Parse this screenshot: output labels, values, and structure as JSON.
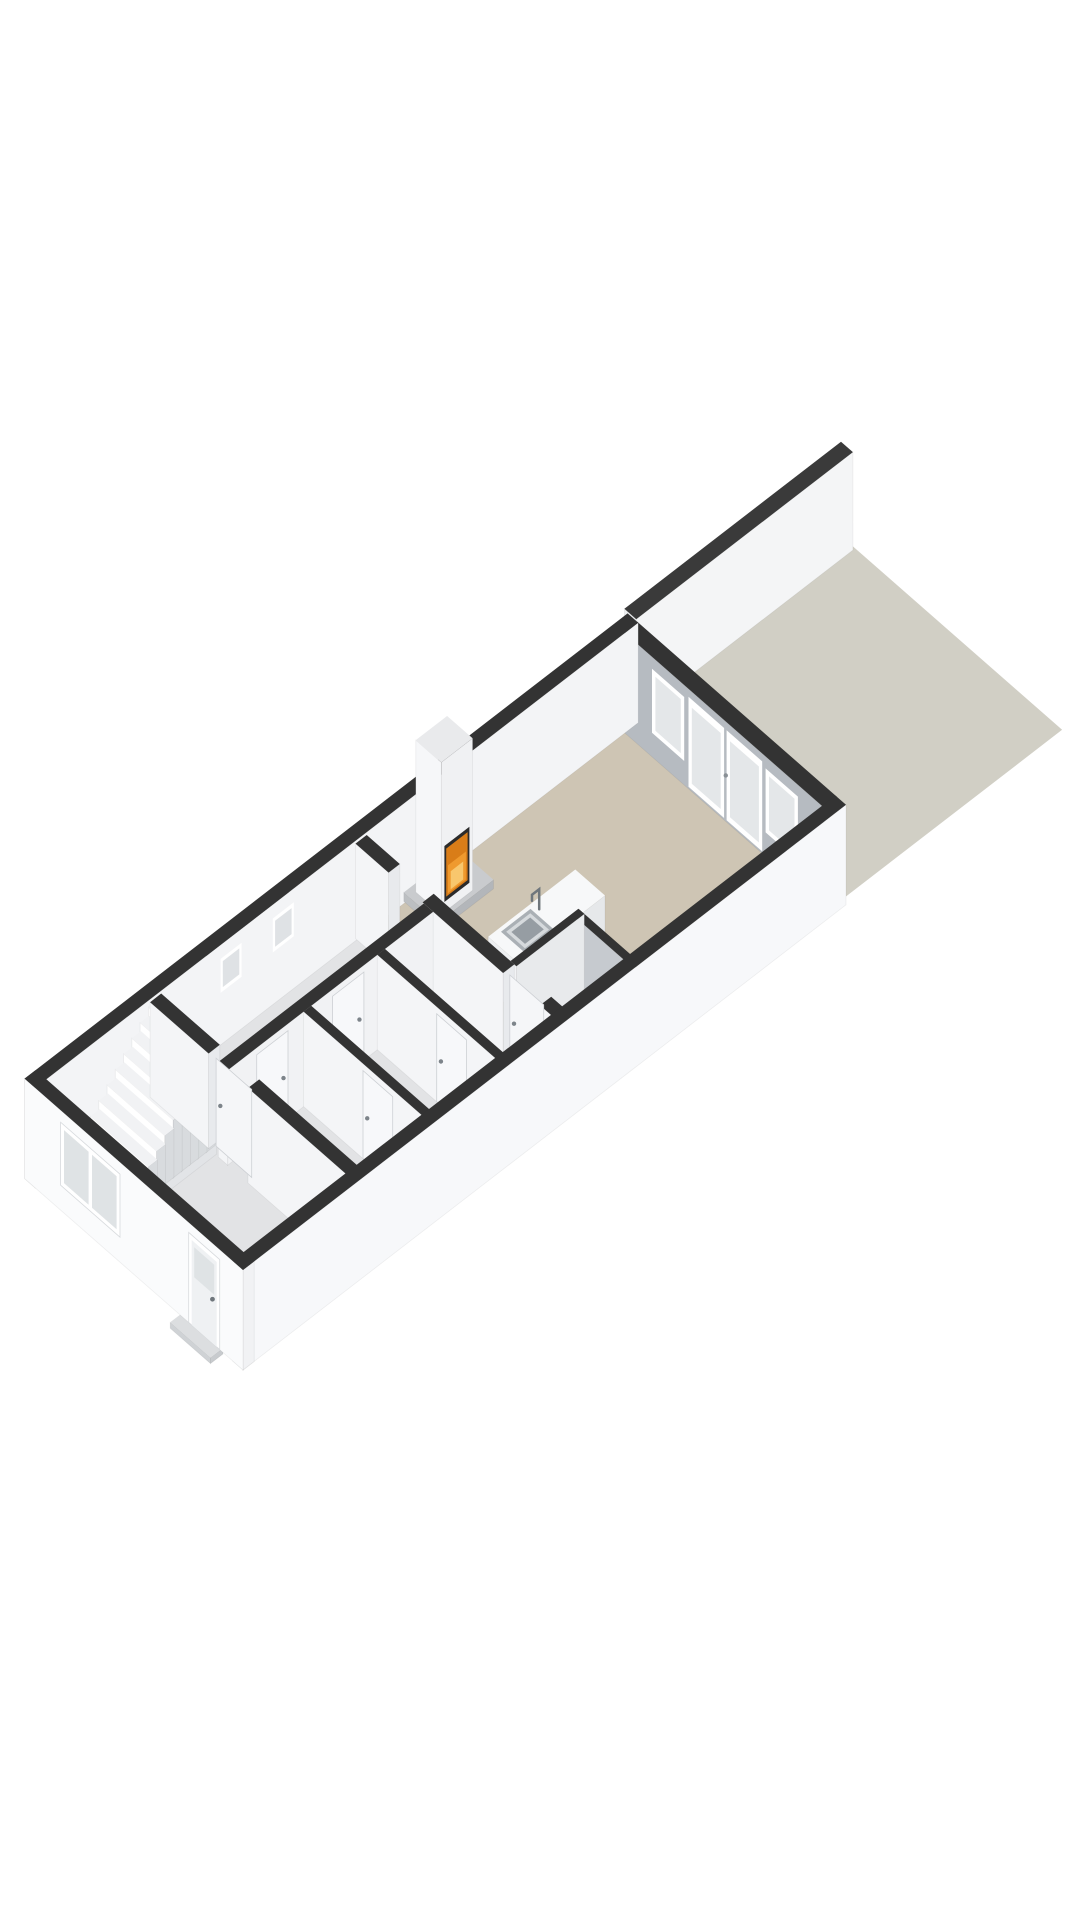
{
  "meta": {
    "type": "3d-floorplan-render",
    "floor": "ground-floor",
    "background": "#ffffff"
  },
  "palette": {
    "wall_top": "#333333",
    "face_bright": "#fafbfc",
    "face_light": "#f2f3f5",
    "face_shade": "#eceef1",
    "face_gray": "#b6bbc1",
    "face_gray_deep": "#c6cacf",
    "floor_gray": "#e2e3e5",
    "floor_tan": "#cec5b4",
    "floor_nook": "#dfe1e3",
    "garden": "#d1cfc5",
    "glass": "#e4e7e9",
    "frame": "#ffffff",
    "fire_dark": "#2b2b2b",
    "fire_base": "#d97d18",
    "fire_mid": "#ef9a2e",
    "fire_hi": "#f8c76d",
    "metal": "#6f767c",
    "edge": "rgba(0,0,0,0.06)"
  },
  "projection": {
    "origin": [
      243,
      1370
    ],
    "ux": 44.67,
    "uy": 34.46,
    "wx": 42.41,
    "wy": 37.17
  },
  "scene": {
    "items": [
      {
        "n": "garden-parcel",
        "t": "floor",
        "z": 0,
        "f": "#d1cfc5",
        "pts": [
          [
            13.5,
            0.12
          ],
          [
            18.45,
            0.12
          ],
          [
            18.45,
            5.1
          ],
          [
            13.5,
            5.1
          ]
        ]
      },
      {
        "n": "garden-boundary-wall",
        "t": "prism",
        "u1": 13.55,
        "u2": 18.4,
        "w1": 5.0,
        "w2": 5.28,
        "z0": 0,
        "z1": 98,
        "ft": "#3a3a3a",
        "fu": "#eceef0",
        "fw": "#f4f5f6"
      },
      {
        "n": "side-roof-slat",
        "t": "prism",
        "u1": 4.65,
        "u2": 6.45,
        "w1": 5.2,
        "w2": 5.27,
        "z0": 0,
        "z1": 55,
        "ft": "#3e4043",
        "fu": "#4a4d50",
        "fw": "#55585c"
      },
      {
        "n": "side-roof-slat",
        "t": "prism",
        "u1": 4.65,
        "u2": 6.45,
        "w1": 5.45,
        "w2": 5.52,
        "z0": 0,
        "z1": 52,
        "ft": "#3e4043",
        "fu": "#4a4d50",
        "fw": "#55585c"
      },
      {
        "n": "side-roof-slat",
        "t": "prism",
        "u1": 4.65,
        "u2": 6.45,
        "w1": 5.7,
        "w2": 5.77,
        "z0": 0,
        "z1": 49,
        "ft": "#3e4043",
        "fu": "#4a4d50",
        "fw": "#55585c"
      },
      {
        "n": "hall-floor",
        "t": "floor",
        "z": 6,
        "f": "#e2e3e5",
        "pts": [
          [
            0.22,
            0.22
          ],
          [
            7.2,
            0.22
          ],
          [
            7.2,
            4.93
          ],
          [
            0.22,
            4.93
          ]
        ]
      },
      {
        "n": "living-room-floor",
        "t": "floor",
        "z": 6,
        "f": "#cec5b4",
        "pts": [
          [
            7.2,
            0.22
          ],
          [
            13.23,
            0.22
          ],
          [
            13.23,
            4.93
          ],
          [
            7.2,
            4.93
          ]
        ]
      },
      {
        "n": "back-facade-wall",
        "t": "prism",
        "u1": 13.2,
        "u2": 13.5,
        "w1": 0.22,
        "w2": 4.93,
        "z0": 0,
        "z1": 100,
        "ft": "#333333",
        "fu": "#b6bbc1",
        "fw": "#f0f1f3"
      },
      {
        "n": "back-window-left",
        "t": "quad",
        "plane": "u",
        "at": 13.2,
        "a1": 0.82,
        "a2": 1.58,
        "b1": 24,
        "b2": 88,
        "f": "#ffffff"
      },
      {
        "n": "back-window-left-glass",
        "t": "quad",
        "plane": "u",
        "at": 13.2,
        "a1": 0.9,
        "a2": 1.5,
        "b1": 29,
        "b2": 83,
        "f": "#e4e7e9"
      },
      {
        "n": "back-door-left",
        "t": "quad",
        "plane": "u",
        "at": 13.2,
        "a1": 1.66,
        "a2": 2.5,
        "b1": 2,
        "b2": 92,
        "f": "#ffffff"
      },
      {
        "n": "back-door-left-glass",
        "t": "quad",
        "plane": "u",
        "at": 13.2,
        "a1": 1.74,
        "a2": 2.42,
        "b1": 8,
        "b2": 84,
        "f": "#e4e7e9"
      },
      {
        "n": "back-door-right",
        "t": "quad",
        "plane": "u",
        "at": 13.2,
        "a1": 2.56,
        "a2": 3.4,
        "b1": 2,
        "b2": 92,
        "f": "#ffffff"
      },
      {
        "n": "back-door-right-glass",
        "t": "quad",
        "plane": "u",
        "at": 13.2,
        "a1": 2.64,
        "a2": 3.32,
        "b1": 8,
        "b2": 84,
        "f": "#e4e7e9"
      },
      {
        "n": "back-door-handle",
        "t": "dot",
        "u": 2.52,
        "w": 4.93,
        "plane": "u",
        "at": 13.2,
        "a": 2.52,
        "b": 46,
        "r": 2.2,
        "f": "#8a9096"
      },
      {
        "n": "back-window-right",
        "t": "quad",
        "plane": "u",
        "at": 13.2,
        "a1": 3.5,
        "a2": 4.26,
        "b1": 24,
        "b2": 88,
        "f": "#ffffff"
      },
      {
        "n": "back-window-right-glass",
        "t": "quad",
        "plane": "u",
        "at": 13.2,
        "a1": 3.58,
        "a2": 4.18,
        "b1": 29,
        "b2": 83,
        "f": "#e4e7e9"
      },
      {
        "n": "left-exterior-wall",
        "t": "prism",
        "u1": 0,
        "u2": 13.5,
        "w1": 4.9,
        "w2": 5.15,
        "z0": 0,
        "z1": 100,
        "ft": "#333333",
        "fu": "#f6f7f8",
        "fw": "#f3f4f6"
      },
      {
        "n": "left-wall-window",
        "t": "quad",
        "plane": "w",
        "at": 4.9,
        "a1": 4.15,
        "a2": 4.62,
        "b1": 52,
        "b2": 86,
        "f": "#ffffff"
      },
      {
        "n": "left-wall-window-glass",
        "t": "quad",
        "plane": "w",
        "at": 4.9,
        "a1": 4.2,
        "a2": 4.57,
        "b1": 56,
        "b2": 82,
        "f": "#dfe2e5"
      },
      {
        "n": "left-wall-window",
        "t": "quad",
        "plane": "w",
        "at": 4.9,
        "a1": 5.32,
        "a2": 5.79,
        "b1": 52,
        "b2": 86,
        "f": "#ffffff"
      },
      {
        "n": "left-wall-window-glass",
        "t": "quad",
        "plane": "w",
        "at": 4.9,
        "a1": 5.37,
        "a2": 5.74,
        "b1": 56,
        "b2": 82,
        "f": "#dfe2e5"
      },
      {
        "n": "fireplace-plinth",
        "t": "prism",
        "u1": 8.28,
        "u2": 9.52,
        "w1": 4.12,
        "w2": 4.93,
        "z0": 0,
        "z1": 9,
        "ft": "#c9cbce",
        "fu": "#bcbfc2",
        "fw": "#b3b6ba"
      },
      {
        "n": "fireplace-chimney",
        "t": "prism",
        "u1": 8.55,
        "u2": 9.25,
        "w1": 4.33,
        "w2": 4.93,
        "z0": 0,
        "z1": 152,
        "ft": "#e9eaec",
        "fu": "#f6f7f9",
        "fw": "#f0f1f3"
      },
      {
        "n": "fireplace-firebox",
        "t": "quad",
        "plane": "w",
        "at": 4.33,
        "a1": 8.62,
        "a2": 9.18,
        "b1": 10,
        "b2": 66,
        "f": "#2b2b2b"
      },
      {
        "n": "fireplace-fire",
        "t": "quad",
        "plane": "w",
        "at": 4.33,
        "a1": 8.66,
        "a2": 9.14,
        "b1": 14,
        "b2": 62,
        "f": "#d97d18"
      },
      {
        "n": "fireplace-fire-mid",
        "t": "quad",
        "plane": "w",
        "at": 4.33,
        "a1": 8.7,
        "a2": 9.1,
        "b1": 16,
        "b2": 44,
        "f": "#ef9a2e"
      },
      {
        "n": "fireplace-fire-glow",
        "t": "quad",
        "plane": "w",
        "at": 4.33,
        "a1": 8.76,
        "a2": 9.04,
        "b1": 18,
        "b2": 36,
        "f": "#f8c76d"
      },
      {
        "n": "kitchen-nook-floor",
        "t": "floor",
        "z": 6.5,
        "f": "#dfe1e3",
        "pts": [
          [
            7.45,
            0.28
          ],
          [
            8.95,
            0.28
          ],
          [
            8.95,
            1.52
          ],
          [
            7.45,
            1.52
          ]
        ]
      },
      {
        "n": "kitchen-island",
        "t": "prism",
        "u1": 8.1,
        "u2": 10.05,
        "w1": 2.05,
        "w2": 2.75,
        "z0": 0,
        "z1": 52,
        "ft": "#f7f8f9",
        "fu": "#eef0f2",
        "fw": "#e6e8ea"
      },
      {
        "n": "sink-rim",
        "t": "quad",
        "plane": "top",
        "at": 52,
        "a1": 8.32,
        "a2": 8.98,
        "b1": 2.12,
        "b2": 2.68,
        "f": "#aab0b5"
      },
      {
        "n": "sink-basin",
        "t": "quad",
        "plane": "top",
        "at": 52,
        "a1": 8.38,
        "a2": 8.92,
        "b1": 2.18,
        "b2": 2.62,
        "f": "#d6dadd"
      },
      {
        "n": "sink-bowl",
        "t": "quad",
        "plane": "top",
        "at": 52,
        "a1": 8.44,
        "a2": 8.86,
        "b1": 2.24,
        "b2": 2.56,
        "f": "#969da3"
      },
      {
        "n": "faucet",
        "t": "line",
        "pts3": [
          [
            9.08,
            2.58,
            52
          ],
          [
            9.08,
            2.58,
            72
          ],
          [
            8.92,
            2.58,
            72
          ],
          [
            8.92,
            2.58,
            66
          ]
        ],
        "s": "#6f767c",
        "sw": 2.5
      },
      {
        "n": "kitchen-nook-wall-back",
        "t": "prism",
        "u1": 8.82,
        "u2": 8.97,
        "w1": 0.28,
        "w2": 1.52,
        "z0": 0,
        "z1": 95,
        "ft": "#333333",
        "fu": "#c6cacf",
        "fw": "#eceef0"
      },
      {
        "n": "kitchen-nook-wall-side",
        "t": "prism",
        "u1": 7.45,
        "u2": 8.97,
        "w1": 1.4,
        "w2": 1.54,
        "z0": 0,
        "z1": 95,
        "ft": "#333333",
        "fu": "#f2f3f5",
        "fw": "#e8eaec"
      },
      {
        "n": "living-divider-wall-seg",
        "t": "prism",
        "u1": 7.2,
        "u2": 7.45,
        "w1": 0.22,
        "w2": 0.58,
        "z0": 0,
        "z1": 95,
        "ft": "#333333",
        "fu": "#f4f5f7",
        "fw": "#e8eaed"
      },
      {
        "n": "living-divider-wall-seg",
        "t": "prism",
        "u1": 7.2,
        "u2": 7.45,
        "w1": 1.45,
        "w2": 3.35,
        "z0": 0,
        "z1": 95,
        "ft": "#333333",
        "fu": "#f4f5f7",
        "fw": "#e8eaed"
      },
      {
        "n": "living-divider-wall-seg",
        "t": "prism",
        "u1": 7.2,
        "u2": 7.45,
        "w1": 4.15,
        "w2": 4.93,
        "z0": 0,
        "z1": 95,
        "ft": "#333333",
        "fu": "#f4f5f7",
        "fw": "#e8eaed"
      },
      {
        "n": "kitchen-door-leaf",
        "t": "quad",
        "plane": "u",
        "at": 7.32,
        "a1": 0.62,
        "a2": 1.42,
        "b1": 0,
        "b2": 90,
        "f": "#f5f6f8",
        "st": "#cdd0d4"
      },
      {
        "n": "kitchen-door-handle",
        "t": "dot",
        "plane": "u",
        "at": 7.32,
        "a": 1.32,
        "b": 45,
        "r": 2.2,
        "f": "#7d848a"
      },
      {
        "n": "corridor-wall",
        "t": "prism",
        "u1": 2.6,
        "u2": 7.2,
        "w1": 3.1,
        "w2": 3.32,
        "z0": 0,
        "z1": 95,
        "ft": "#333333",
        "fu": "#f4f5f7",
        "fw": "#f1f2f4"
      },
      {
        "n": "corridor-door-leaf",
        "t": "quad",
        "plane": "w",
        "at": 3.1,
        "a1": 3.25,
        "a2": 3.95,
        "b1": 0,
        "b2": 88,
        "f": "#f7f8fa",
        "st": "#cdd0d4"
      },
      {
        "n": "corridor-door-handle",
        "t": "dot",
        "plane": "w",
        "at": 3.1,
        "a": 3.85,
        "b": 44,
        "r": 2.2,
        "f": "#7d848a"
      },
      {
        "n": "corridor-door-leaf",
        "t": "quad",
        "plane": "w",
        "at": 3.1,
        "a1": 4.95,
        "a2": 5.65,
        "b1": 0,
        "b2": 88,
        "f": "#f7f8fa",
        "st": "#cdd0d4"
      },
      {
        "n": "corridor-door-handle",
        "t": "dot",
        "plane": "w",
        "at": 3.1,
        "a": 5.55,
        "b": 44,
        "r": 2.2,
        "f": "#7d848a"
      },
      {
        "n": "toilet-partition-wall",
        "t": "prism",
        "u1": 4.3,
        "u2": 4.47,
        "w1": 0.22,
        "w2": 3.1,
        "z0": 0,
        "z1": 95,
        "ft": "#333333",
        "fu": "#f4f5f7",
        "fw": "#e8eaed"
      },
      {
        "n": "toilet-door-leaf",
        "t": "quad",
        "plane": "u",
        "at": 4.3,
        "a1": 1.0,
        "a2": 1.7,
        "b1": 0,
        "b2": 88,
        "f": "#f7f8fa",
        "st": "#cdd0d4"
      },
      {
        "n": "toilet-door-handle",
        "t": "dot",
        "plane": "u",
        "at": 4.3,
        "a": 1.6,
        "b": 44,
        "r": 2.2,
        "f": "#7d848a"
      },
      {
        "n": "storage-partition-wall",
        "t": "prism",
        "u1": 5.95,
        "u2": 6.12,
        "w1": 0.22,
        "w2": 3.1,
        "z0": 0,
        "z1": 95,
        "ft": "#333333",
        "fu": "#f4f5f7",
        "fw": "#e8eaed"
      },
      {
        "n": "storage-door-leaf",
        "t": "quad",
        "plane": "u",
        "at": 5.95,
        "a1": 1.0,
        "a2": 1.7,
        "b1": 0,
        "b2": 88,
        "f": "#f7f8fa",
        "st": "#cdd0d4"
      },
      {
        "n": "storage-door-handle",
        "t": "dot",
        "plane": "u",
        "at": 5.95,
        "a": 1.6,
        "b": 44,
        "r": 2.2,
        "f": "#7d848a"
      },
      {
        "n": "stair-stringer",
        "t": "prism",
        "u1": 0.85,
        "u2": 2.62,
        "w1": 3.38,
        "w2": 3.52,
        "z0": 0,
        "z1": 42,
        "ft": "#e8eaec",
        "fu": "#f6f7f9",
        "fw": "#e2e4e7"
      },
      {
        "n": 10,
        "t": "stairs",
        "u0": 0.85,
        "tread": 0.185,
        "w1": 3.52,
        "w2": 4.88,
        "rise0": 12,
        "rise": 9.2,
        "ft": "#f1f2f4",
        "fu": "#ffffff",
        "fw": "#d8dbde"
      },
      {
        "n": "front-hall-wall-seg",
        "t": "prism",
        "u1": 2.6,
        "u2": 2.85,
        "w1": 0.22,
        "w2": 2.62,
        "z0": 0,
        "z1": 95,
        "ft": "#333333",
        "fu": "#f4f5f7",
        "fw": "#e8eaed"
      },
      {
        "n": "front-hall-wall-seg",
        "t": "prism",
        "u1": 2.6,
        "u2": 2.85,
        "w1": 3.55,
        "w2": 4.93,
        "z0": 0,
        "z1": 95,
        "ft": "#333333",
        "fu": "#f4f5f7",
        "fw": "#e8eaed"
      },
      {
        "n": "hall-door-leaf",
        "t": "quad",
        "plane": "u",
        "at": 2.72,
        "a1": 2.66,
        "a2": 3.5,
        "b1": 0,
        "b2": 88,
        "f": "#f5f6f8",
        "st": "#cdd0d4"
      },
      {
        "n": "hall-door-handle",
        "t": "dot",
        "plane": "u",
        "at": 2.72,
        "a": 3.4,
        "b": 44,
        "r": 2.2,
        "f": "#7d848a"
      },
      {
        "n": "right-exterior-wall",
        "t": "prism",
        "u1": 0,
        "u2": 13.5,
        "w1": 0,
        "w2": 0.25,
        "z0": 0,
        "z1": 100,
        "ft": "#333333",
        "fu": "#f8f9fa",
        "fw": "#f7f8fa"
      },
      {
        "n": "front-door-step",
        "t": "prism",
        "u1": -0.3,
        "u2": -0.02,
        "w1": 0.45,
        "w2": 1.4,
        "z0": 0,
        "z1": 6,
        "ft": "#dcdee0",
        "fu": "#cfd2d5",
        "fw": "#c8cbce"
      },
      {
        "n": "front-facade-wall",
        "t": "prism",
        "u1": 0,
        "u2": 0.25,
        "w1": 0,
        "w2": 5.15,
        "z0": 0,
        "z1": 100,
        "ft": "#333333",
        "fu": "#fafbfc",
        "fw": "#f1f2f4"
      },
      {
        "n": "front-window-frame",
        "t": "quad",
        "plane": "u",
        "at": 0,
        "a1": 2.9,
        "a2": 4.3,
        "b1": 25,
        "b2": 88,
        "f": "#ffffff",
        "st": "#d7dadd"
      },
      {
        "n": "front-window-glass",
        "t": "quad",
        "plane": "u",
        "at": 0,
        "a1": 2.98,
        "a2": 3.56,
        "b1": 30,
        "b2": 83,
        "f": "#dfe3e5"
      },
      {
        "n": "front-window-glass",
        "t": "quad",
        "plane": "u",
        "at": 0,
        "a1": 3.64,
        "a2": 4.22,
        "b1": 30,
        "b2": 83,
        "f": "#dfe3e5"
      },
      {
        "n": "front-door-frame",
        "t": "quad",
        "plane": "u",
        "at": 0,
        "a1": 0.55,
        "a2": 1.28,
        "b1": 0,
        "b2": 90,
        "f": "#ffffff",
        "st": "#d7dadd"
      },
      {
        "n": "front-door-leaf",
        "t": "quad",
        "plane": "u",
        "at": 0,
        "a1": 0.62,
        "a2": 1.21,
        "b1": 0,
        "b2": 85,
        "f": "#eff1f3"
      },
      {
        "n": "front-door-glass",
        "t": "quad",
        "plane": "u",
        "at": 0,
        "a1": 0.68,
        "a2": 1.15,
        "b1": 50,
        "b2": 80,
        "f": "#dfe3e5"
      },
      {
        "n": "front-door-handle",
        "t": "dot",
        "plane": "u",
        "at": 0,
        "a": 0.72,
        "b": 44,
        "r": 2.4,
        "f": "#6f767c"
      }
    ]
  }
}
